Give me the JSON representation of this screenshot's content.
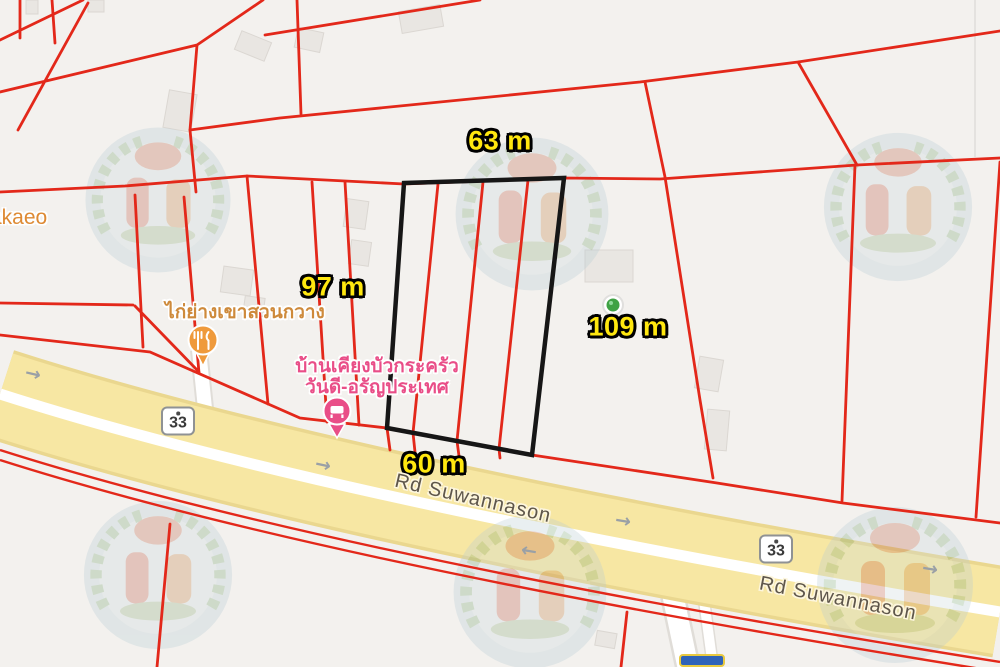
{
  "title": "Land plot cadastral map on road Suwannason",
  "map_labels": {
    "dimension_top": "63 m",
    "dimension_left": "97 m",
    "dimension_right": "109 m",
    "dimension_bottom": "60 m"
  },
  "road": {
    "name": "Rd Suwannason",
    "route_badge": "33",
    "arrow_right_glyph": "→",
    "arrow_left_glyph": "←"
  },
  "places": {
    "town_label_partial": "akaeo",
    "restaurant_label": "ไก่ย่างเขาสวนกวาง",
    "guesthouse_label_line1": "บ้านเคียงบัวกระครัว",
    "guesthouse_label_line2": "วันดี-อรัญประเทศ"
  },
  "colors": {
    "background": "#F3F1EE",
    "parcel_line": "#E3281A",
    "highlight_line": "#161616",
    "dim_text": "#FFE70F",
    "road_fill": "#F7E7A3",
    "road_casing": "#EAD78F",
    "road_label": "#5E564B",
    "badge_border": "#8F9294",
    "badge_text": "#3A3A3A",
    "arrow_gray": "#9AA0A6",
    "restaurant_pin": "#EF9A3C",
    "guesthouse_pin": "#E94E88",
    "restaurant_label": "#CE8A3B",
    "town_label": "#DE8A33",
    "guesthouse_label": "#E94E88",
    "park_dot": "#3FA244",
    "building_fill": "#E9E6E2",
    "building_stroke": "#DBD7D2",
    "minor_road": "#FFFFFF",
    "minor_road_casing": "#E0DDD8",
    "partial_badge_blue": "#2F63B8",
    "partial_badge_border": "#E8C93F"
  }
}
